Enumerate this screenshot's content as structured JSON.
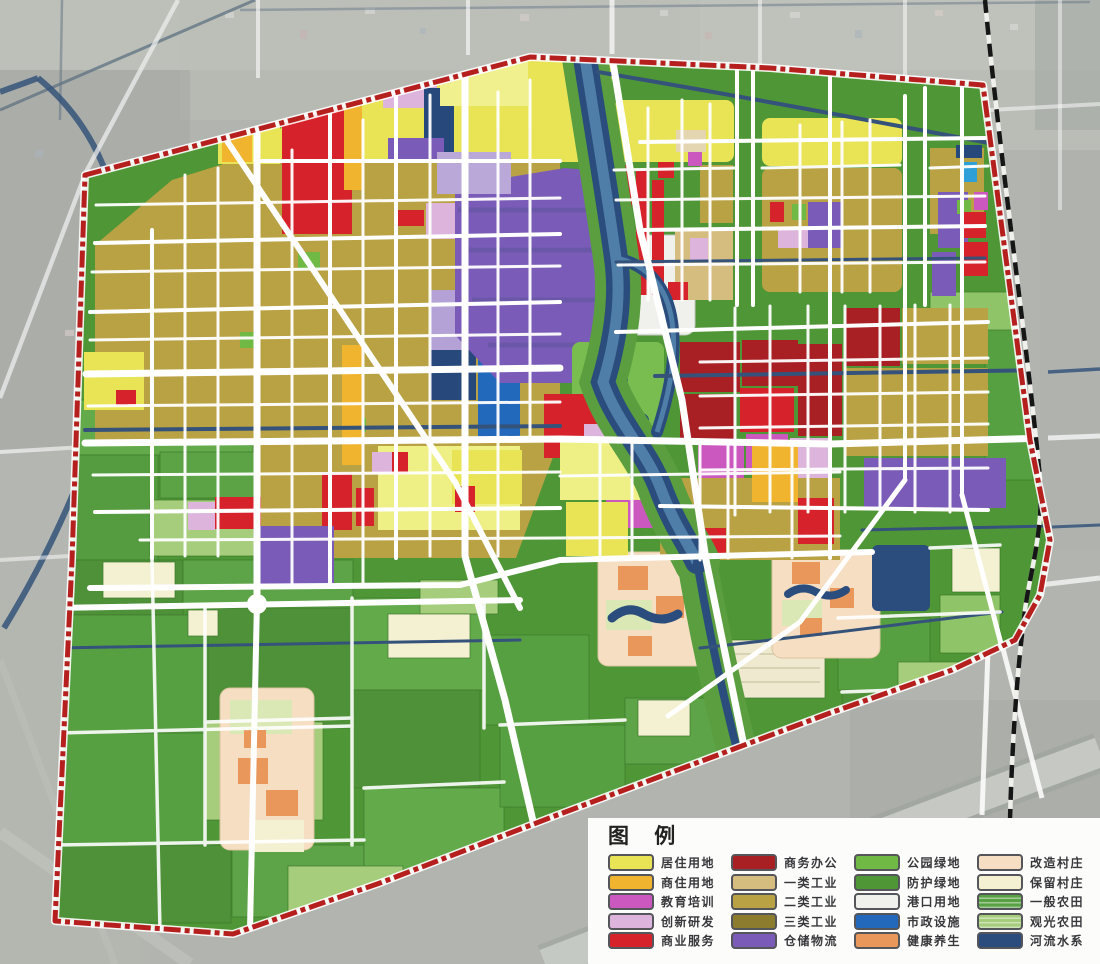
{
  "legend": {
    "title": "图 例",
    "columns": [
      {
        "items": [
          {
            "key": "residential",
            "label": "居住用地",
            "color": "#e9e356"
          },
          {
            "key": "commercial-residential",
            "label": "商住用地",
            "color": "#f0b42e"
          },
          {
            "key": "education",
            "label": "教育培训",
            "color": "#cb58bf"
          },
          {
            "key": "innovation",
            "label": "创新研发",
            "color": "#dcb4dc"
          },
          {
            "key": "commercial-service",
            "label": "商业服务",
            "color": "#d6232b"
          }
        ]
      },
      {
        "items": [
          {
            "key": "business-office",
            "label": "商务办公",
            "color": "#a81f24"
          },
          {
            "key": "industry-1",
            "label": "一类工业",
            "color": "#d5bc7f"
          },
          {
            "key": "industry-2",
            "label": "二类工业",
            "color": "#b9a243"
          },
          {
            "key": "industry-3",
            "label": "三类工业",
            "color": "#8c7c2e"
          },
          {
            "key": "warehouse-logistics",
            "label": "仓储物流",
            "color": "#7a5cb8"
          }
        ]
      },
      {
        "items": [
          {
            "key": "park-green",
            "label": "公园绿地",
            "color": "#6fb944"
          },
          {
            "key": "protective-green",
            "label": "防护绿地",
            "color": "#4f9636"
          },
          {
            "key": "port",
            "label": "港口用地",
            "color": "#f0f1ed"
          },
          {
            "key": "municipal",
            "label": "市政设施",
            "color": "#2268bb"
          },
          {
            "key": "wellness",
            "label": "健康养生",
            "color": "#e9975a"
          }
        ]
      },
      {
        "items": [
          {
            "key": "village-renovate",
            "label": "改造村庄",
            "color": "#f5dec1"
          },
          {
            "key": "village-retain",
            "label": "保留村庄",
            "color": "#f4f0d2"
          },
          {
            "key": "farmland-general",
            "label": "一般农田",
            "color": "#58a144",
            "texture": "stripes"
          },
          {
            "key": "farmland-sightseeing",
            "label": "观光农田",
            "color": "#a6cd7c",
            "texture": "stripes"
          },
          {
            "key": "river",
            "label": "河流水系",
            "color": "#2a4d7d"
          }
        ]
      }
    ]
  },
  "map": {
    "colors": {
      "boundary": "#b5201f",
      "railway": "#161616",
      "road": "#ffffff",
      "background": "#b2b5af",
      "water-outside": "#35537a",
      "river-highlight": "#4f7ea8"
    }
  }
}
